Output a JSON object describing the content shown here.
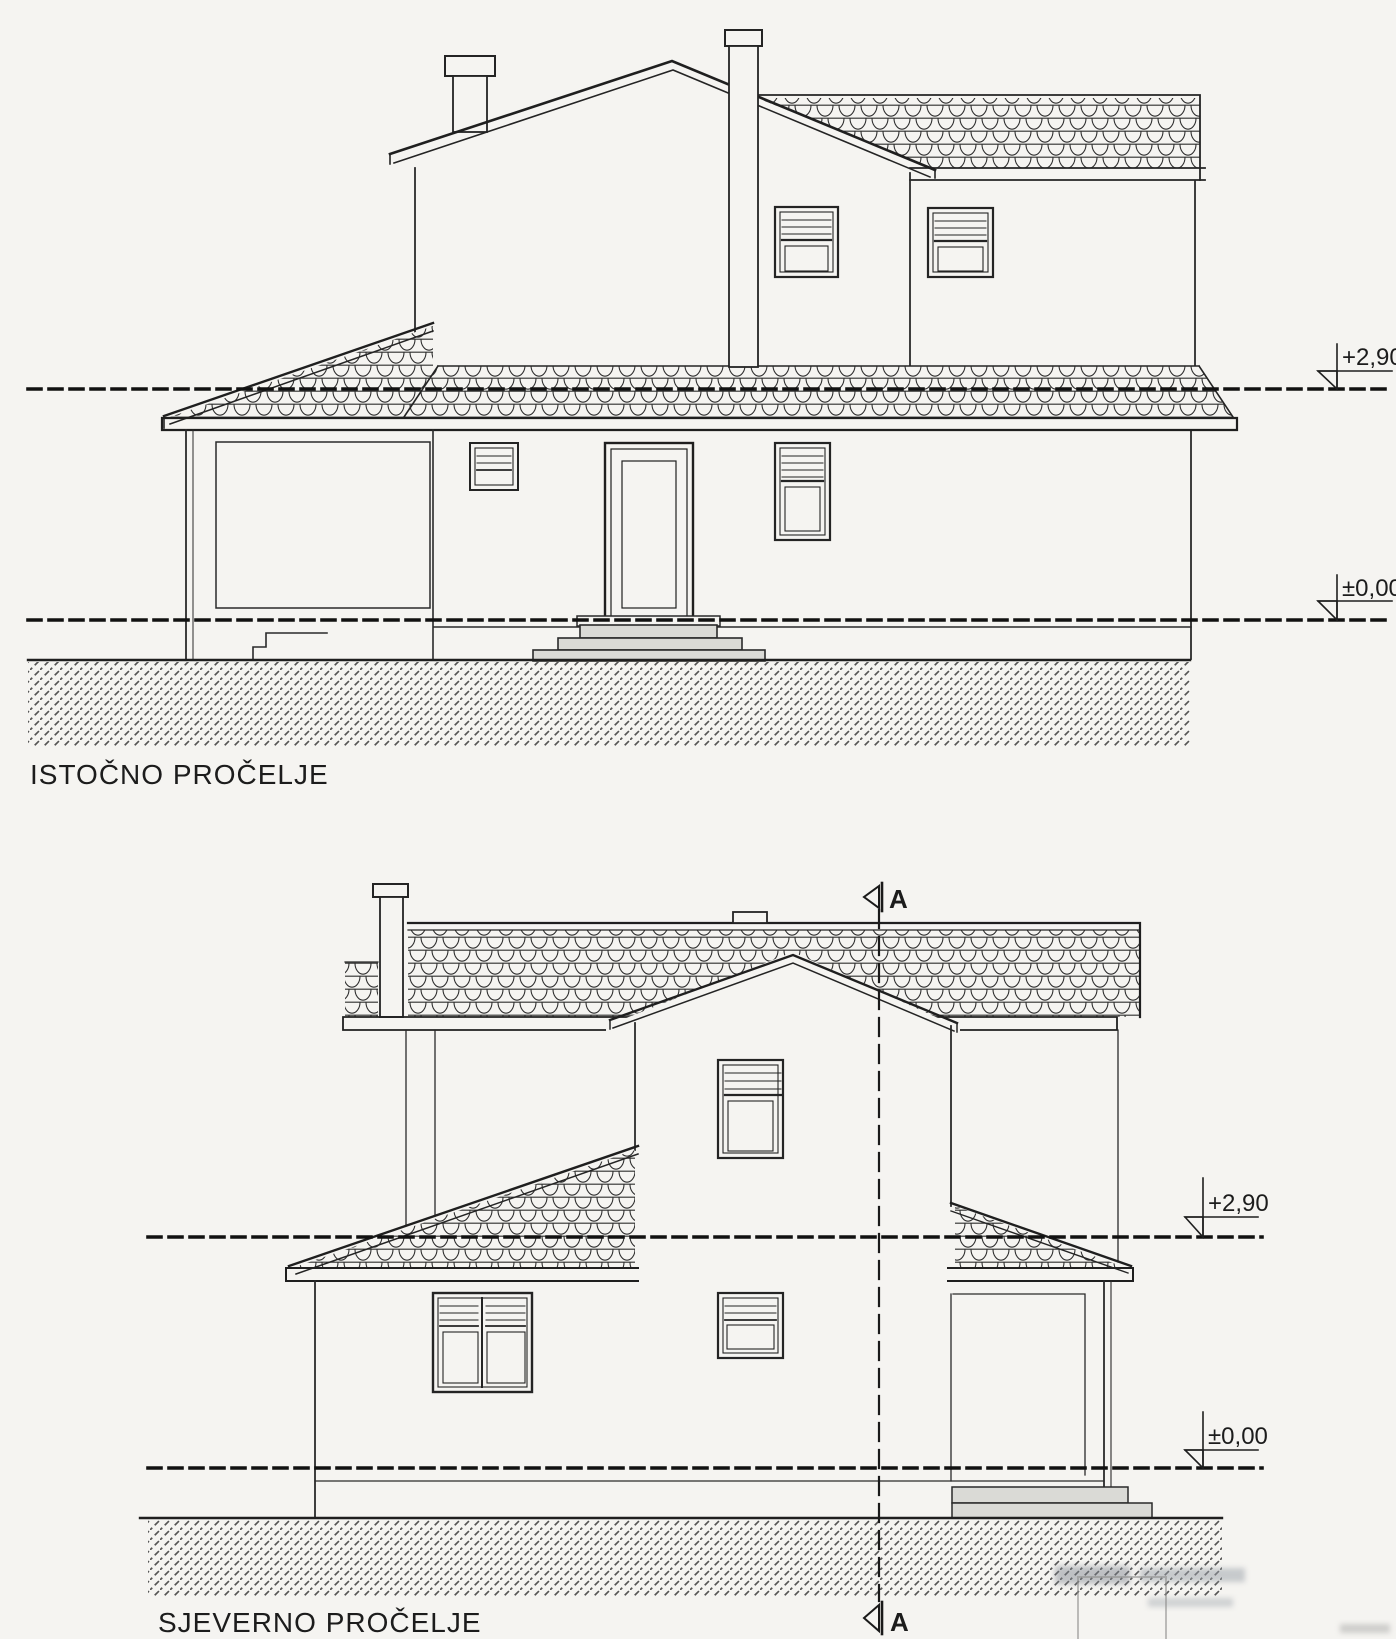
{
  "sheet": {
    "background": "#f5f4f1",
    "ink": "#222222"
  },
  "east_elevation": {
    "title": "ISTOČNO PROČELJE",
    "levels": {
      "upper": "+2,90",
      "ground": "±0,00"
    }
  },
  "north_elevation": {
    "title": "SJEVERNO PROČELJE",
    "levels": {
      "upper": "+2,90",
      "ground": "±0,00"
    },
    "section_marker": {
      "top": "A",
      "bottom": "A"
    }
  }
}
